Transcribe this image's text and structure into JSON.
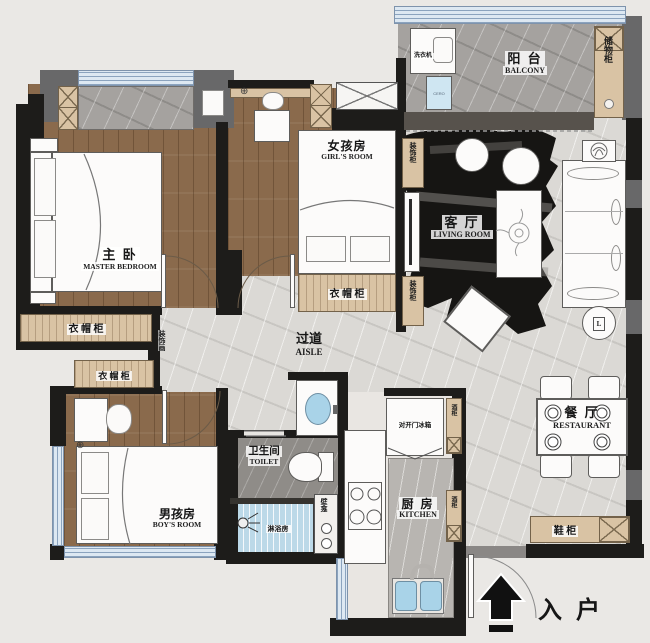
{
  "plan": {
    "rooms": {
      "master": {
        "zh": "主 卧",
        "en": "MASTER BEDROOM"
      },
      "girls": {
        "zh": "女孩房",
        "en": "GIRL'S ROOM"
      },
      "boys": {
        "zh": "男孩房",
        "en": "BOY'S ROOM"
      },
      "living": {
        "zh": "客 厅",
        "en": "LIVING ROOM"
      },
      "balcony": {
        "zh": "阳 台",
        "en": "BALCONY"
      },
      "aisle": {
        "zh": "过道",
        "en": "AISLE"
      },
      "toilet": {
        "zh": "卫生间",
        "en": "TOILET"
      },
      "shower": {
        "zh": "淋浴房"
      },
      "kitchen": {
        "zh": "厨 房",
        "en": "KITCHEN"
      },
      "dining": {
        "zh": "餐 厅",
        "en": "RESTAURANT"
      },
      "entry": {
        "zh": "入 户"
      }
    },
    "fixtures": {
      "washing_machine": "洗衣机",
      "water_point": "CERO",
      "storage_cabinet": "储物柜",
      "wardrobe": "衣 帽 柜",
      "deco_cabinet": "装饰柜",
      "deco_art": "装饰画",
      "fridge": "对开门冰箱",
      "wine_cabinet": "酒柜",
      "shoe_cabinet": "鞋 柜",
      "niche": "壁龛",
      "lamp": "L"
    }
  }
}
